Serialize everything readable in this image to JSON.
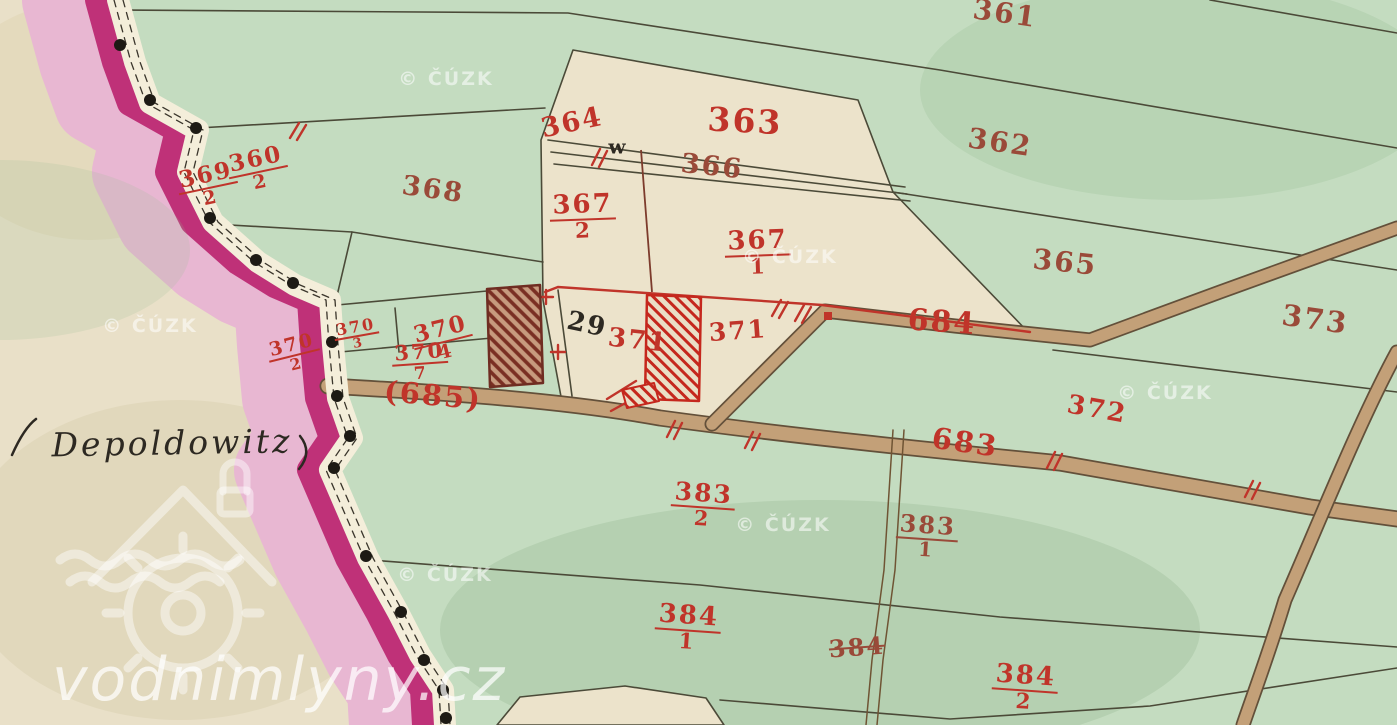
{
  "map": {
    "type": "historical-cadastral-map",
    "place_name": "Depoldowitz",
    "palette": {
      "red": "#c0342a",
      "darkred": "#9a4a39",
      "black": "#2d2922",
      "paper": "#e9e0c8",
      "field_green": "#c4dcc0",
      "road_tan": "#c3a078",
      "boundary_magenta": "#bf3178",
      "boundary_pink": "#e8b7d2",
      "ink": "#4b4a38"
    },
    "labels": [
      {
        "id": "361",
        "kind": "plain",
        "text": "361",
        "x": 1005,
        "y": 14,
        "rot": 8,
        "size": 28,
        "color": "darkred"
      },
      {
        "id": "362",
        "kind": "plain",
        "text": "362",
        "x": 1000,
        "y": 143,
        "rot": 8,
        "size": 28,
        "color": "darkred"
      },
      {
        "id": "363",
        "kind": "plain",
        "text": "363",
        "x": 745,
        "y": 121,
        "rot": 3,
        "size": 33,
        "color": "red"
      },
      {
        "id": "364",
        "kind": "plain",
        "text": "364",
        "x": 572,
        "y": 123,
        "rot": -12,
        "size": 27,
        "color": "red"
      },
      {
        "id": "366",
        "kind": "plain",
        "text": "366",
        "x": 712,
        "y": 167,
        "rot": 6,
        "size": 27,
        "color": "darkred"
      },
      {
        "id": "365",
        "kind": "plain",
        "text": "365",
        "x": 1065,
        "y": 263,
        "rot": 6,
        "size": 28,
        "color": "darkred"
      },
      {
        "id": "367-2",
        "kind": "fraction",
        "num": "367",
        "den": "2",
        "x": 583,
        "y": 217,
        "rot": -2,
        "size": 26,
        "color": "red"
      },
      {
        "id": "367-1",
        "kind": "fraction",
        "num": "367",
        "den": "1",
        "x": 758,
        "y": 253,
        "rot": -2,
        "size": 26,
        "color": "red"
      },
      {
        "id": "368",
        "kind": "plain",
        "text": "368",
        "x": 433,
        "y": 190,
        "rot": 8,
        "size": 27,
        "color": "darkred"
      },
      {
        "id": "360-2",
        "kind": "fraction",
        "num": "360",
        "den": "2",
        "x": 258,
        "y": 170,
        "rot": -12,
        "size": 23,
        "color": "red"
      },
      {
        "id": "369-2",
        "kind": "fraction",
        "num": "369",
        "den": "2",
        "x": 208,
        "y": 186,
        "rot": -12,
        "size": 23,
        "color": "red"
      },
      {
        "id": "370-3",
        "kind": "fraction",
        "num": "370",
        "den": "3",
        "x": 357,
        "y": 335,
        "rot": -10,
        "size": 16,
        "color": "red"
      },
      {
        "id": "370-4",
        "kind": "fraction",
        "num": "370",
        "den": "4",
        "x": 443,
        "y": 340,
        "rot": -14,
        "size": 23,
        "color": "red"
      },
      {
        "id": "370-2",
        "kind": "fraction",
        "num": "370",
        "den": "2",
        "x": 294,
        "y": 354,
        "rot": -14,
        "size": 19,
        "color": "red"
      },
      {
        "id": "370-7",
        "kind": "fraction",
        "num": "370",
        "den": "7",
        "x": 420,
        "y": 362,
        "rot": -4,
        "size": 21,
        "color": "red"
      },
      {
        "id": "685",
        "kind": "plain",
        "text": "(685)",
        "x": 433,
        "y": 396,
        "rot": 5,
        "size": 29,
        "color": "red"
      },
      {
        "id": "29",
        "kind": "plain",
        "text": "29",
        "x": 587,
        "y": 325,
        "rot": 12,
        "size": 26,
        "color": "black"
      },
      {
        "id": "371-house",
        "kind": "plain",
        "text": "371",
        "x": 638,
        "y": 341,
        "rot": 6,
        "size": 26,
        "color": "red"
      },
      {
        "id": "371",
        "kind": "plain",
        "text": "371",
        "x": 738,
        "y": 331,
        "rot": -4,
        "size": 25,
        "color": "red"
      },
      {
        "id": "684",
        "kind": "plain",
        "text": "684",
        "x": 942,
        "y": 323,
        "rot": 4,
        "size": 30,
        "color": "red"
      },
      {
        "id": "683",
        "kind": "plain",
        "text": "683",
        "x": 965,
        "y": 443,
        "rot": 8,
        "size": 29,
        "color": "red"
      },
      {
        "id": "373",
        "kind": "plain",
        "text": "373",
        "x": 1315,
        "y": 320,
        "rot": 8,
        "size": 29,
        "color": "darkred"
      },
      {
        "id": "372",
        "kind": "plain",
        "text": "372",
        "x": 1097,
        "y": 410,
        "rot": 10,
        "size": 26,
        "color": "red"
      },
      {
        "id": "383-2",
        "kind": "fraction",
        "num": "383",
        "den": "2",
        "x": 703,
        "y": 505,
        "rot": 4,
        "size": 25,
        "color": "red"
      },
      {
        "id": "383-1",
        "kind": "fraction",
        "num": "383",
        "den": "1",
        "x": 927,
        "y": 537,
        "rot": 4,
        "size": 24,
        "color": "darkred"
      },
      {
        "id": "384-1",
        "kind": "fraction",
        "num": "384",
        "den": "1",
        "x": 688,
        "y": 628,
        "rot": 4,
        "size": 26,
        "color": "red"
      },
      {
        "id": "384-old",
        "kind": "plain",
        "text": "384",
        "x": 857,
        "y": 648,
        "rot": -4,
        "size": 24,
        "color": "darkred",
        "struck": true
      },
      {
        "id": "384-2",
        "kind": "fraction",
        "num": "384",
        "den": "2",
        "x": 1025,
        "y": 688,
        "rot": 4,
        "size": 26,
        "color": "red"
      },
      {
        "id": "w-mark",
        "kind": "plain",
        "text": "w",
        "x": 618,
        "y": 147,
        "rot": 0,
        "size": 20,
        "color": "black"
      },
      {
        "id": "place-name",
        "kind": "script",
        "text": "Depoldowitz",
        "x": 172,
        "y": 443,
        "rot": -1,
        "size": 33,
        "color": "black"
      }
    ],
    "watermarks": {
      "text": "© ČÚZK",
      "positions": [
        {
          "x": 446,
          "y": 79
        },
        {
          "x": 150,
          "y": 326
        },
        {
          "x": 790,
          "y": 257
        },
        {
          "x": 1165,
          "y": 393
        },
        {
          "x": 783,
          "y": 525
        },
        {
          "x": 445,
          "y": 575
        }
      ],
      "site": "vodnimlyny.cz",
      "site_x": 52,
      "site_y": 645
    }
  }
}
